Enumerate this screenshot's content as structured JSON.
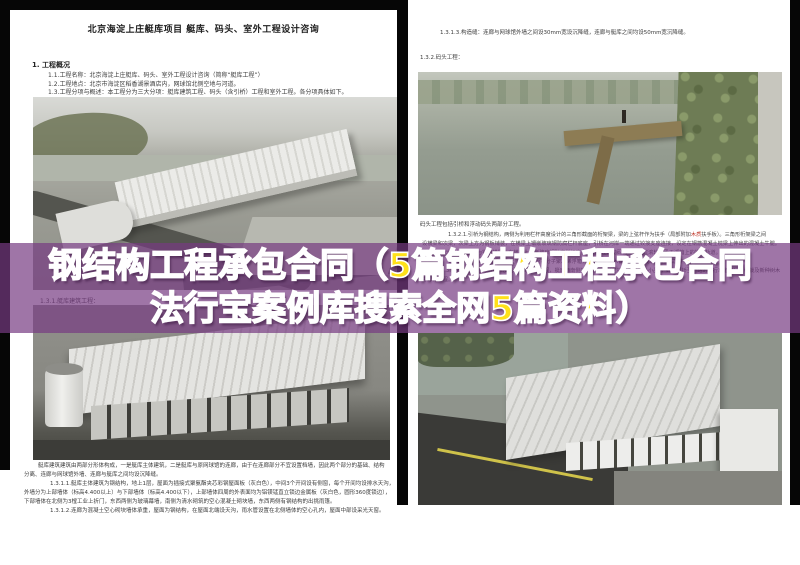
{
  "colors": {
    "band_purple": "#763a82",
    "banner_white": "#ffffff",
    "banner_yellow": "#ffe11a",
    "doc_text": "#3c3c3c",
    "red_note": "#c0392b"
  },
  "banner": {
    "line1_segments": [
      {
        "text": "钢结构工程承包合同（",
        "color": "#ffffff"
      },
      {
        "text": "5篇钢结构工程承包合同",
        "color": "#ffe11a"
      }
    ],
    "line2_segments": [
      {
        "text": "法行宝案例库搜索全网",
        "color": "#ffffff"
      },
      {
        "text": "5篇资料）",
        "color": "#ffe11a"
      }
    ]
  },
  "left_page": {
    "title": "北京海淀上庄艇库项目 艇库、码头、室外工程设计咨询",
    "section_heading": "1.  工程概况",
    "intro_lines": [
      "1.1.工程名称：北京海淀上庄艇库、码头、室外工程设计咨询（简称“艇库工程”）",
      "1.2.工程地点：北京市海淀区稻香湖景酒店内，网球馆北侧空地与河道。",
      "1.3.工程分项与概述：本工程分为三大分项：艇库建筑工程、码头（含引桥）工程和室外工程。各分项具体如下。"
    ],
    "sub_heading": "1.3.1.艇库建筑工程：",
    "body_lines": [
      "艇库建筑建筑由两部分形体构成，一是艇库主体建筑，二是艇库与原网球馆的连廊，由于在连廊部分不宜设置档墙，因此两个部分的基础、结构",
      "分离、连廊与网球馆外墙、连廊与艇库之间均设沉降缝。",
      "1.3.1.1.艇库主体建筑为钢结构，地上1层，屋面为插接式聚氨酯夹芯彩钢屋面板（灰白色），中间3个开间设有侧窗，每个开间均设排水天沟，",
      "外墙分为上部墙体（标高4.400以上）与下部墙体（标高4.400以下），上部墙体四周的外表面均为铝镁锰直立锁边金属板（灰白色，圆形360度锁边），",
      "下部墙体在北侧为3樘工业上折门，东西两侧为玻璃幕墙，南侧为清水砌筑的空心混凝土砌块墙，东西两侧有钢结构的出挑雨篷。",
      "1.3.1.2.连廊为混凝土空心砌块墙体承重，屋面为钢结构，在屋面北端设天沟，雨水管设置在北侧墙体的空心孔内，屋面中部设采光天窗。"
    ]
  },
  "right_page": {
    "line_a": "1.3.1.3.构造缝：连廊与网球馆外墙之间设30mm宽设沉降缝，连廊与艇库之间均设50mm宽沉降缝。",
    "line_b": "1.3.2.码头工程：",
    "caption": "码头工程包括引桥和浮动码头两部分工程。",
    "para_line1_segments": [
      {
        "text": "1.3.2.1.引桥为钢结构，两侧为利用栏杆高度设计的三角形截面的桁架梁，梁的上弦杆作为扶手（局部附加",
        "color": "#444444"
      },
      {
        "text": "木质",
        "color": "#c0392b"
      },
      {
        "text": "扶手板）。三角形桁架梁之间",
        "color": "#444444"
      }
    ],
    "para_lines": [
      "设横梁和次梁，次梁上方为钢板铺装，在横梁上镶嵌玻璃钢防腐栏杆底座，引桥在河岸一端通过铰接支座连接，设定在钢筋混凝土枕梁上伸出的混凝土牛腿。",
      "梁长共8.0米，伏梁上方为钢管横梁，在横梁上镶嵌玻璃钢防腐栏杆底座，引桥在浮动码头一端通过滚轮支承于浮箱上的钢制轨道。",
      "1.3.2.2.浮动码头为钢结构框架，下部为高分子聚乙烯浮箱，面层为防腐木铺装，四周设玻璃钢防腐栏杆。",
      "1.3.3.室外工程包括：给排水及强弱电的外线工程，艇库西南侧的铺装工程（包括其中的室外小品），码头引桥至道路的自行车道工程，移栽及新种树木",
      "等绿化工程。"
    ]
  }
}
